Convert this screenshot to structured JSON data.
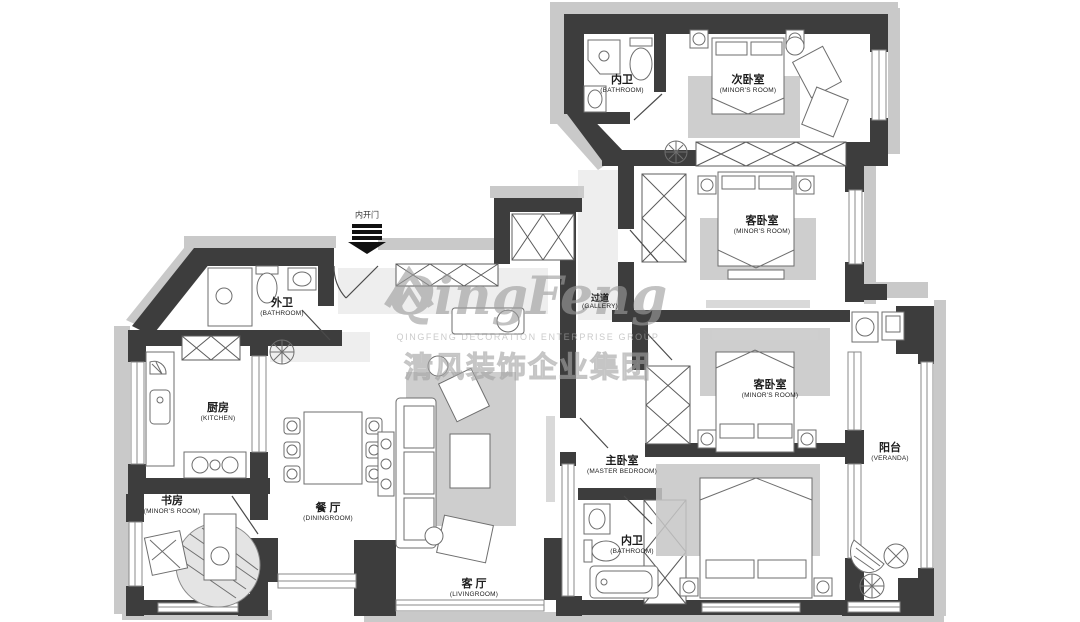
{
  "entrance": {
    "label": "内开门"
  },
  "rooms": [
    {
      "id": "bath-top",
      "zh": "内卫",
      "en": "(BATHROOM)"
    },
    {
      "id": "bed-top",
      "zh": "次卧室",
      "en": "(MINOR'S ROOM)"
    },
    {
      "id": "bed-second",
      "zh": "客卧室",
      "en": "(MINOR'S ROOM)"
    },
    {
      "id": "gallery",
      "zh": "过道",
      "en": "(GALLERY)"
    },
    {
      "id": "bed-third",
      "zh": "客卧室",
      "en": "(MINOR'S ROOM)"
    },
    {
      "id": "veranda",
      "zh": "阳台",
      "en": "(VERANDA)"
    },
    {
      "id": "master",
      "zh": "主卧室",
      "en": "(MASTER BEDROOM)"
    },
    {
      "id": "bath-master",
      "zh": "内卫",
      "en": "(BATHROOM)"
    },
    {
      "id": "bath-outer",
      "zh": "外卫",
      "en": "(BATHROOM)"
    },
    {
      "id": "kitchen",
      "zh": "厨房",
      "en": "(KITCHEN)"
    },
    {
      "id": "study",
      "zh": "书房",
      "en": "(MINOR'S ROOM)"
    },
    {
      "id": "dining",
      "zh": "餐 厅",
      "en": "(DININGROOM)"
    },
    {
      "id": "living",
      "zh": "客 厅",
      "en": "(LIVINGROOM)"
    }
  ],
  "watermark": {
    "script_left": "Qing",
    "script_right": "Feng",
    "caps_line": "QINGFENG  DECORATION  ENTERPRISE  GROUP",
    "cn_line": "清风装饰企业集团"
  },
  "colors": {
    "wall": "#3d3d3d",
    "wall_shadow": "#c9c9c9",
    "furniture_line": "#6e6e6e",
    "rug_fill": "#c5c5c5",
    "label_text": "#1c1c1c",
    "watermark_gray": "#a9a9a9"
  }
}
